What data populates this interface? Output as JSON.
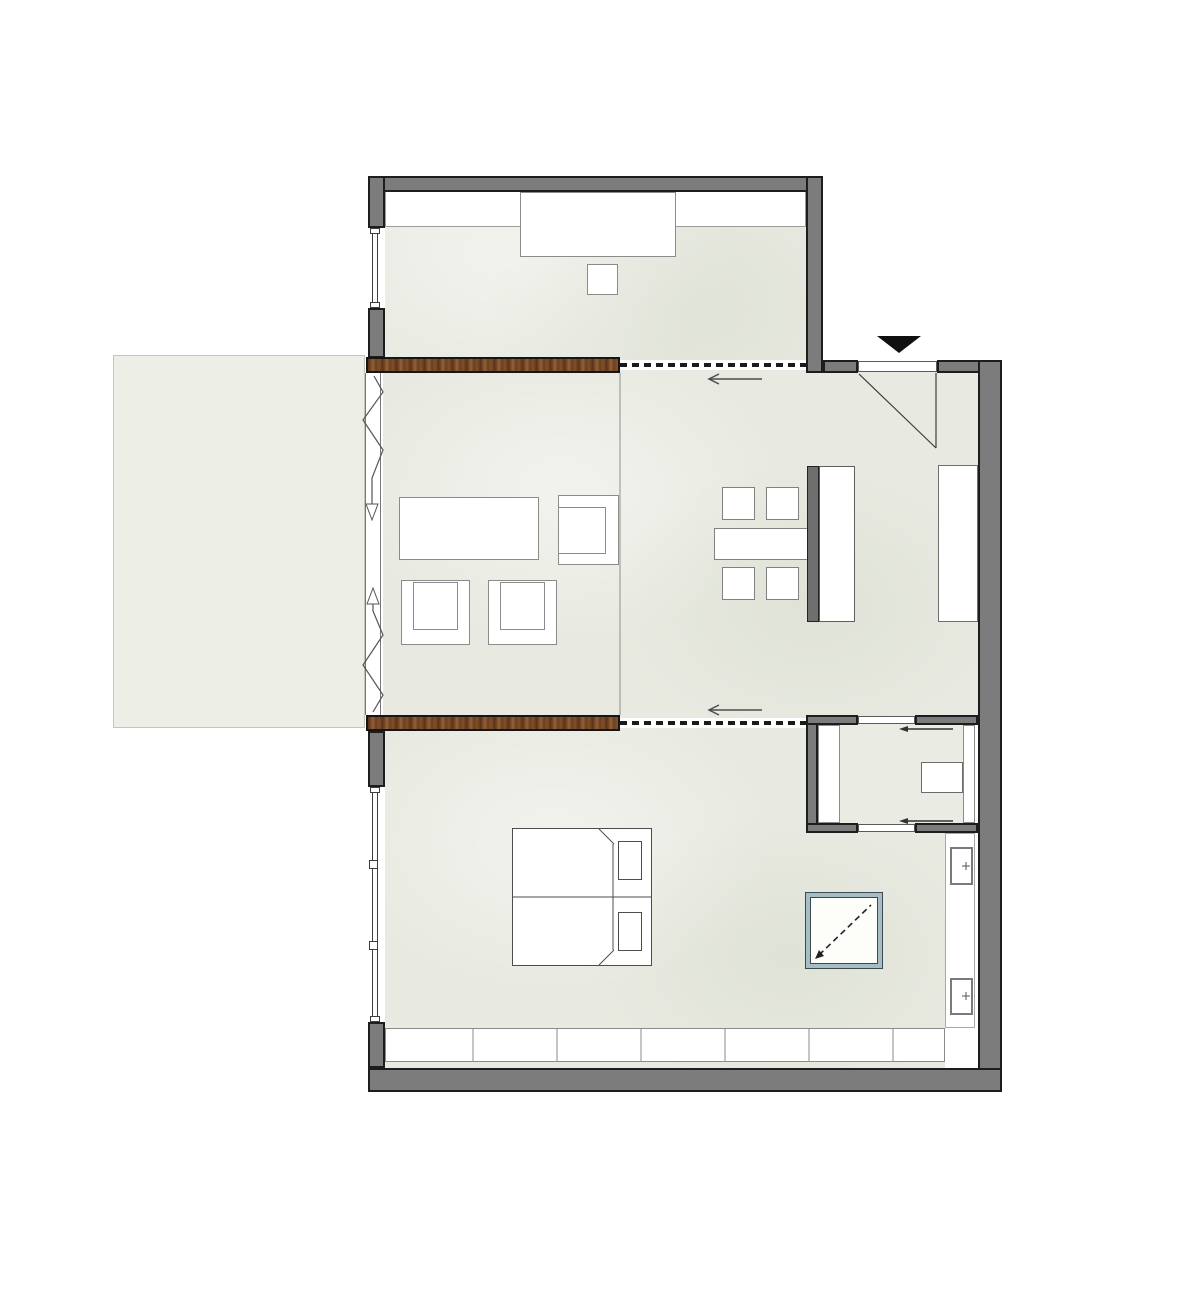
{
  "canvas": {
    "width": 1200,
    "height": 1290,
    "background": "#ffffff"
  },
  "palette": {
    "wall_gray": "#7c7c7c",
    "wall_outline": "#1d1d1d",
    "floor_tint": "#e8eae1",
    "terrace_tint": "#edefe7",
    "wood_brown": "#7c4a26",
    "furniture_outline": "#8b8b8b",
    "island_dark": "#6f6f6f",
    "accent_teal": "#a5bec6",
    "annotation_line": "#4d4d4d",
    "track_black": "#1b1b1b"
  },
  "shapes": [
    {
      "name": "terrace-deck",
      "x": 113,
      "y": 355,
      "w": 252,
      "h": 373,
      "fill": "#edefe7",
      "stroke": "#c3c7ba",
      "sw": 1
    },
    {
      "name": "top-room-floor",
      "cls": "floor",
      "x": 385,
      "y": 192,
      "w": 421,
      "h": 168,
      "fill": "#e8eae1"
    },
    {
      "name": "main-area-floor",
      "cls": "floor",
      "x": 383,
      "y": 366,
      "w": 595,
      "h": 352,
      "fill": "#e8eae1"
    },
    {
      "name": "bedroom-floor",
      "cls": "floor",
      "x": 385,
      "y": 718,
      "w": 560,
      "h": 350,
      "fill": "#e8eae1"
    },
    {
      "name": "bathroom-floor",
      "x": 818,
      "y": 725,
      "w": 157,
      "h": 98,
      "fill": "#eaece4"
    },
    {
      "name": "top-room-closet-band",
      "x": 385,
      "y": 190,
      "w": 421,
      "h": 37,
      "fill": "#ffffff",
      "stroke": "#9b9b9b",
      "sw": 1
    },
    {
      "name": "top-room-sideboard",
      "x": 520,
      "y": 192,
      "w": 156,
      "h": 65,
      "fill": "#ffffff",
      "stroke": "#8b8b8b",
      "sw": 1.5
    },
    {
      "name": "top-room-stool",
      "x": 587,
      "y": 264,
      "w": 31,
      "h": 31,
      "fill": "#ffffff",
      "stroke": "#8b8b8b",
      "sw": 1.5
    },
    {
      "name": "coffee-table",
      "x": 399,
      "y": 497,
      "w": 140,
      "h": 63,
      "fill": "#ffffff",
      "stroke": "#8b8b8b",
      "sw": 1.5
    },
    {
      "name": "side-armchair-outer",
      "x": 558,
      "y": 495,
      "w": 61,
      "h": 70,
      "fill": "#ffffff",
      "stroke": "#8b8b8b",
      "sw": 1.5
    },
    {
      "name": "side-armchair-seat",
      "x": 558,
      "y": 507,
      "w": 48,
      "h": 47,
      "stroke": "#8b8b8b",
      "sw": 1.5
    },
    {
      "name": "armchair-left-outer",
      "x": 401,
      "y": 580,
      "w": 69,
      "h": 65,
      "fill": "#ffffff",
      "stroke": "#8b8b8b",
      "sw": 1.5
    },
    {
      "name": "armchair-left-seat",
      "x": 413,
      "y": 582,
      "w": 45,
      "h": 48,
      "stroke": "#8b8b8b",
      "sw": 1.5
    },
    {
      "name": "armchair-right-outer",
      "x": 488,
      "y": 580,
      "w": 69,
      "h": 65,
      "fill": "#ffffff",
      "stroke": "#8b8b8b",
      "sw": 1.5
    },
    {
      "name": "armchair-right-seat",
      "x": 500,
      "y": 582,
      "w": 45,
      "h": 48,
      "stroke": "#8b8b8b",
      "sw": 1.5
    },
    {
      "name": "dining-chair-1",
      "x": 722,
      "y": 487,
      "w": 33,
      "h": 33,
      "fill": "#ffffff",
      "stroke": "#818181",
      "sw": 1.5
    },
    {
      "name": "dining-chair-2",
      "x": 766,
      "y": 487,
      "w": 33,
      "h": 33,
      "fill": "#ffffff",
      "stroke": "#818181",
      "sw": 1.5
    },
    {
      "name": "dining-chair-3",
      "x": 722,
      "y": 567,
      "w": 33,
      "h": 33,
      "fill": "#ffffff",
      "stroke": "#818181",
      "sw": 1.5
    },
    {
      "name": "dining-chair-4",
      "x": 766,
      "y": 567,
      "w": 33,
      "h": 33,
      "fill": "#ffffff",
      "stroke": "#818181",
      "sw": 1.5
    },
    {
      "name": "dining-table",
      "x": 714,
      "y": 528,
      "w": 94,
      "h": 32,
      "fill": "#ffffff",
      "stroke": "#818181",
      "sw": 1.5
    },
    {
      "name": "island-back-panel",
      "x": 807,
      "y": 466,
      "w": 12,
      "h": 156,
      "fill": "#6f6f6f",
      "stroke": "#222222",
      "sw": 1
    },
    {
      "name": "kitchen-island",
      "x": 819,
      "y": 466,
      "w": 36,
      "h": 156,
      "fill": "#ffffff",
      "stroke": "#5e5e5e",
      "sw": 1.5
    },
    {
      "name": "kitchen-counter",
      "x": 938,
      "y": 465,
      "w": 40,
      "h": 157,
      "fill": "#ffffff",
      "stroke": "#6e6e6e",
      "sw": 1.5
    },
    {
      "name": "bed",
      "x": 512,
      "y": 828,
      "w": 140,
      "h": 138,
      "fill": "#ffffff",
      "stroke": "#4c4c4c",
      "sw": 1
    },
    {
      "name": "pillow-top",
      "x": 618,
      "y": 841,
      "w": 24,
      "h": 39,
      "fill": "#ffffff",
      "stroke": "#4c4c4c",
      "sw": 1
    },
    {
      "name": "pillow-bottom",
      "x": 618,
      "y": 912,
      "w": 24,
      "h": 39,
      "fill": "#ffffff",
      "stroke": "#4c4c4c",
      "sw": 1
    },
    {
      "name": "shower-skylight",
      "cls": "glass",
      "x": 806,
      "y": 893,
      "w": 76,
      "h": 75
    },
    {
      "name": "wall-niche",
      "x": 945,
      "y": 833,
      "w": 30,
      "h": 195,
      "fill": "#ffffff",
      "stroke": "#a8a8a8",
      "sw": 1
    },
    {
      "name": "radiator-top",
      "x": 950,
      "y": 847,
      "w": 23,
      "h": 38,
      "fill": "#ffffff",
      "stroke": "#7a7a7a",
      "sw": 2
    },
    {
      "name": "radiator-bottom",
      "x": 950,
      "y": 978,
      "w": 23,
      "h": 37,
      "fill": "#ffffff",
      "stroke": "#7a7a7a",
      "sw": 2
    },
    {
      "name": "built-in-wardrobe",
      "x": 385,
      "y": 1028,
      "w": 560,
      "h": 34,
      "fill": "#ffffff",
      "stroke": "#8b8b8b",
      "sw": 1
    },
    {
      "name": "bath-cabinet-left",
      "x": 818,
      "y": 725,
      "w": 22,
      "h": 98,
      "fill": "#ffffff",
      "stroke": "#8b8b8b",
      "sw": 1
    },
    {
      "name": "bath-counter-right",
      "x": 963,
      "y": 725,
      "w": 12,
      "h": 98,
      "fill": "#ffffff",
      "stroke": "#8b8b8b",
      "sw": 1
    },
    {
      "name": "bath-sink",
      "x": 921,
      "y": 762,
      "w": 42,
      "h": 31,
      "fill": "#ffffff",
      "stroke": "#6b6b6b",
      "sw": 1
    },
    {
      "name": "track-band-upper",
      "x": 618,
      "y": 360,
      "w": 192,
      "h": 10,
      "fill": "#ffffff"
    },
    {
      "name": "track-band-lower",
      "x": 618,
      "y": 718,
      "w": 192,
      "h": 10,
      "fill": "#ffffff"
    },
    {
      "name": "wall-top",
      "cls": "wall",
      "x": 368,
      "y": 176,
      "w": 455,
      "h": 16
    },
    {
      "name": "wall-left-upper-a",
      "cls": "wall",
      "x": 368,
      "y": 176,
      "w": 17,
      "h": 52
    },
    {
      "name": "wall-left-upper-b",
      "cls": "wall",
      "x": 368,
      "y": 308,
      "w": 17,
      "h": 50
    },
    {
      "name": "wall-top-room-right",
      "cls": "wall",
      "x": 806,
      "y": 176,
      "w": 17,
      "h": 197
    },
    {
      "name": "wall-entry-top-left",
      "cls": "wall",
      "x": 823,
      "y": 360,
      "w": 35,
      "h": 13
    },
    {
      "name": "wall-entry-top-right",
      "cls": "wall",
      "x": 937,
      "y": 360,
      "w": 65,
      "h": 13
    },
    {
      "name": "wall-outer-right",
      "cls": "wall",
      "x": 978,
      "y": 360,
      "w": 24,
      "h": 732
    },
    {
      "name": "wall-outer-bottom",
      "cls": "wall",
      "x": 368,
      "y": 1068,
      "w": 634,
      "h": 24
    },
    {
      "name": "wall-bedroom-left-a",
      "cls": "wall",
      "x": 368,
      "y": 731,
      "w": 17,
      "h": 56
    },
    {
      "name": "wall-bedroom-left-b",
      "cls": "wall",
      "x": 368,
      "y": 1022,
      "w": 17,
      "h": 46
    },
    {
      "name": "wall-bath-left",
      "cls": "wall",
      "x": 806,
      "y": 715,
      "w": 12,
      "h": 118
    },
    {
      "name": "wall-bath-top-left",
      "cls": "wall",
      "x": 806,
      "y": 715,
      "w": 52,
      "h": 10
    },
    {
      "name": "wall-bath-top-right",
      "cls": "wall",
      "x": 915,
      "y": 715,
      "w": 63,
      "h": 10
    },
    {
      "name": "wall-bath-bottom-left",
      "cls": "wall",
      "x": 806,
      "y": 823,
      "w": 52,
      "h": 10
    },
    {
      "name": "wall-bath-bottom-right",
      "cls": "wall",
      "x": 915,
      "y": 823,
      "w": 63,
      "h": 10
    },
    {
      "name": "sliding-wood-door-upper",
      "cls": "wood",
      "x": 366,
      "y": 357,
      "w": 254,
      "h": 16
    },
    {
      "name": "sliding-wood-door-lower",
      "cls": "wood",
      "x": 366,
      "y": 715,
      "w": 254,
      "h": 16
    },
    {
      "name": "window-top-opening",
      "x": 368,
      "y": 228,
      "w": 17,
      "h": 80,
      "fill": "#ffffff"
    },
    {
      "name": "window-top-glass",
      "x": 372,
      "y": 231,
      "w": 6,
      "h": 74,
      "fill": "#ffffff",
      "stroke": "#3d3d3d",
      "sw": 1
    },
    {
      "name": "window-top-cap-a",
      "x": 370,
      "y": 228,
      "w": 10,
      "h": 6,
      "fill": "#ffffff",
      "stroke": "#3d3d3d",
      "sw": 1
    },
    {
      "name": "window-top-cap-b",
      "x": 370,
      "y": 302,
      "w": 10,
      "h": 6,
      "fill": "#ffffff",
      "stroke": "#3d3d3d",
      "sw": 1
    },
    {
      "name": "window-bedroom-opening",
      "x": 368,
      "y": 787,
      "w": 17,
      "h": 235,
      "fill": "#ffffff"
    },
    {
      "name": "window-bedroom-glass",
      "x": 372,
      "y": 791,
      "w": 6,
      "h": 227,
      "fill": "#ffffff",
      "stroke": "#3d3d3d",
      "sw": 1
    },
    {
      "name": "window-bedroom-cap-a",
      "x": 370,
      "y": 787,
      "w": 10,
      "h": 6,
      "fill": "#ffffff",
      "stroke": "#3d3d3d",
      "sw": 1
    },
    {
      "name": "window-bedroom-cap-b",
      "x": 370,
      "y": 1016,
      "w": 10,
      "h": 6,
      "fill": "#ffffff",
      "stroke": "#3d3d3d",
      "sw": 1
    },
    {
      "name": "window-bedroom-mullion-a",
      "x": 369,
      "y": 860,
      "w": 9,
      "h": 9,
      "fill": "#ffffff",
      "stroke": "#3d3d3d",
      "sw": 1
    },
    {
      "name": "window-bedroom-mullion-b",
      "x": 369,
      "y": 941,
      "w": 9,
      "h": 9,
      "fill": "#ffffff",
      "stroke": "#3d3d3d",
      "sw": 1
    },
    {
      "name": "entrance-door-panel",
      "x": 858,
      "y": 361,
      "w": 79,
      "h": 11,
      "fill": "#ffffff",
      "stroke": "#5a5a5a",
      "sw": 1
    },
    {
      "name": "bath-pocket-door-top",
      "x": 858,
      "y": 716,
      "w": 57,
      "h": 8,
      "fill": "#ffffff",
      "stroke": "#5a5a5a",
      "sw": 1
    },
    {
      "name": "bath-pocket-door-bottom",
      "x": 858,
      "y": 824,
      "w": 57,
      "h": 8,
      "fill": "#ffffff",
      "stroke": "#5a5a5a",
      "sw": 1
    }
  ],
  "strokes": [
    {
      "name": "living-zone-divider",
      "type": "line",
      "x1": 620,
      "y1": 373,
      "x2": 620,
      "y2": 715,
      "stroke": "#909090",
      "sw": 1
    },
    {
      "name": "wardrobe-divider-1",
      "type": "line",
      "x1": 473,
      "y1": 1029,
      "x2": 473,
      "y2": 1061,
      "stroke": "#8b8b8b",
      "sw": 1
    },
    {
      "name": "wardrobe-divider-2",
      "type": "line",
      "x1": 557,
      "y1": 1029,
      "x2": 557,
      "y2": 1061,
      "stroke": "#8b8b8b",
      "sw": 1
    },
    {
      "name": "wardrobe-divider-3",
      "type": "line",
      "x1": 641,
      "y1": 1029,
      "x2": 641,
      "y2": 1061,
      "stroke": "#8b8b8b",
      "sw": 1
    },
    {
      "name": "wardrobe-divider-4",
      "type": "line",
      "x1": 725,
      "y1": 1029,
      "x2": 725,
      "y2": 1061,
      "stroke": "#8b8b8b",
      "sw": 1
    },
    {
      "name": "wardrobe-divider-5",
      "type": "line",
      "x1": 809,
      "y1": 1029,
      "x2": 809,
      "y2": 1061,
      "stroke": "#8b8b8b",
      "sw": 1
    },
    {
      "name": "wardrobe-divider-6",
      "type": "line",
      "x1": 893,
      "y1": 1029,
      "x2": 893,
      "y2": 1061,
      "stroke": "#8b8b8b",
      "sw": 1
    },
    {
      "name": "door-track-upper",
      "type": "line",
      "x1": 620,
      "y1": 365,
      "x2": 806,
      "y2": 365,
      "stroke": "#1b1b1b",
      "sw": 4,
      "dash": "7 5"
    },
    {
      "name": "door-track-lower",
      "type": "line",
      "x1": 620,
      "y1": 723,
      "x2": 806,
      "y2": 723,
      "stroke": "#1b1b1b",
      "sw": 4,
      "dash": "7 5"
    },
    {
      "name": "slide-arrow-upper-shaft",
      "type": "line",
      "x1": 709,
      "y1": 379,
      "x2": 762,
      "y2": 379,
      "stroke": "#4d4d4d",
      "sw": 1.5
    },
    {
      "name": "slide-arrow-upper-head",
      "type": "polyline",
      "points": "719,374 709,379 719,384",
      "stroke": "#4d4d4d",
      "sw": 1.5
    },
    {
      "name": "slide-arrow-lower-shaft",
      "type": "line",
      "x1": 709,
      "y1": 710,
      "x2": 762,
      "y2": 710,
      "stroke": "#4d4d4d",
      "sw": 1.5
    },
    {
      "name": "slide-arrow-lower-head",
      "type": "polyline",
      "points": "719,705 709,710 719,715",
      "stroke": "#4d4d4d",
      "sw": 1.5
    },
    {
      "name": "bath-arrow-top-shaft",
      "type": "line",
      "x1": 908,
      "y1": 729,
      "x2": 953,
      "y2": 729,
      "stroke": "#333333",
      "sw": 1.5
    },
    {
      "name": "bath-arrow-top-head",
      "type": "polygon",
      "points": "908,726 908,732 899,729",
      "fill": "#333333"
    },
    {
      "name": "bath-arrow-bottom-shaft",
      "type": "line",
      "x1": 908,
      "y1": 821,
      "x2": 953,
      "y2": 821,
      "stroke": "#333333",
      "sw": 1.5
    },
    {
      "name": "bath-arrow-bottom-head",
      "type": "polygon",
      "points": "908,818 908,824 899,821",
      "fill": "#333333"
    },
    {
      "name": "fold-door-rail-outer",
      "type": "line",
      "x1": 365.5,
      "y1": 373,
      "x2": 365.5,
      "y2": 715,
      "stroke": "#777777",
      "sw": 1
    },
    {
      "name": "fold-door-rail-inner",
      "type": "line",
      "x1": 380.5,
      "y1": 373,
      "x2": 380.5,
      "y2": 715,
      "stroke": "#777777",
      "sw": 1
    },
    {
      "name": "fold-door-zigzag-top",
      "type": "polyline",
      "points": "374,376 383,392 363,420 383,450 372,478 372,504",
      "stroke": "#555555",
      "sw": 1.2
    },
    {
      "name": "fold-door-arrow-down",
      "type": "polygon",
      "points": "366,504 378,504 372,520",
      "fill": "#ffffff",
      "stroke": "#555555",
      "sw": 1
    },
    {
      "name": "fold-door-zigzag-bottom",
      "type": "polyline",
      "points": "373,712 383,695 363,665 383,635 373,611 373,604",
      "stroke": "#555555",
      "sw": 1.2
    },
    {
      "name": "fold-door-arrow-up",
      "type": "polygon",
      "points": "367,604 379,604 373,588",
      "fill": "#ffffff",
      "stroke": "#555555",
      "sw": 1
    },
    {
      "name": "entry-door-swing-diagonal",
      "type": "line",
      "x1": 859,
      "y1": 374,
      "x2": 936,
      "y2": 448,
      "stroke": "#3c3c3c",
      "sw": 1.2
    },
    {
      "name": "entry-door-swing-leaf",
      "type": "line",
      "x1": 936,
      "y1": 373,
      "x2": 936,
      "y2": 448,
      "stroke": "#3c3c3c",
      "sw": 1.2
    },
    {
      "name": "entrance-marker-triangle",
      "type": "polygon",
      "points": "877,336 921,336 899,353",
      "fill": "#101010"
    },
    {
      "name": "bed-center-line",
      "type": "line",
      "x1": 513,
      "y1": 897,
      "x2": 651,
      "y2": 897,
      "stroke": "#4c4c4c",
      "sw": 1
    },
    {
      "name": "bed-blanket-edge",
      "type": "line",
      "x1": 613,
      "y1": 844,
      "x2": 613,
      "y2": 950,
      "stroke": "#4c4c4c",
      "sw": 1
    },
    {
      "name": "bed-fold-top",
      "type": "line",
      "x1": 599,
      "y1": 829,
      "x2": 614,
      "y2": 844,
      "stroke": "#4c4c4c",
      "sw": 1
    },
    {
      "name": "bed-fold-bottom",
      "type": "line",
      "x1": 599,
      "y1": 965,
      "x2": 614,
      "y2": 950,
      "stroke": "#4c4c4c",
      "sw": 1
    },
    {
      "name": "skylight-diagonal",
      "type": "line",
      "x1": 819,
      "y1": 955,
      "x2": 871,
      "y2": 905,
      "stroke": "#222222",
      "sw": 1.6,
      "dash": "6 4"
    },
    {
      "name": "skylight-arrow-head",
      "type": "polygon",
      "points": "815,959 824,956 819,950",
      "fill": "#222222"
    },
    {
      "name": "radiator-top-plus-h",
      "type": "line",
      "x1": 962,
      "y1": 866,
      "x2": 970,
      "y2": 866,
      "stroke": "#555555",
      "sw": 1
    },
    {
      "name": "radiator-top-plus-v",
      "type": "line",
      "x1": 966,
      "y1": 862,
      "x2": 966,
      "y2": 870,
      "stroke": "#555555",
      "sw": 1
    },
    {
      "name": "radiator-bottom-plus-h",
      "type": "line",
      "x1": 962,
      "y1": 996,
      "x2": 970,
      "y2": 996,
      "stroke": "#555555",
      "sw": 1
    },
    {
      "name": "radiator-bottom-plus-v",
      "type": "line",
      "x1": 966,
      "y1": 992,
      "x2": 966,
      "y2": 1000,
      "stroke": "#555555",
      "sw": 1
    }
  ]
}
